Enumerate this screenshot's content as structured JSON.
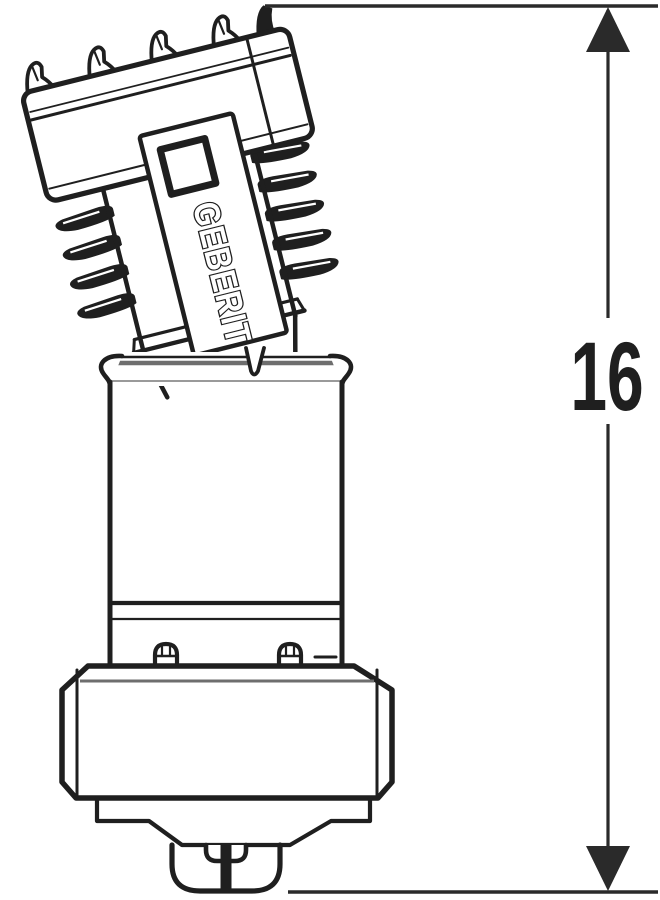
{
  "drawing": {
    "kind": "technical line drawing of angled Geberit connector fitting",
    "brand_label": "GEBERIT",
    "dimension": {
      "value": "16"
    }
  },
  "colors": {
    "ink": "#1f1f1f",
    "accent_gray": "#6e6e6e",
    "dimension_line": "#2a2a2a",
    "background": "#ffffff"
  }
}
